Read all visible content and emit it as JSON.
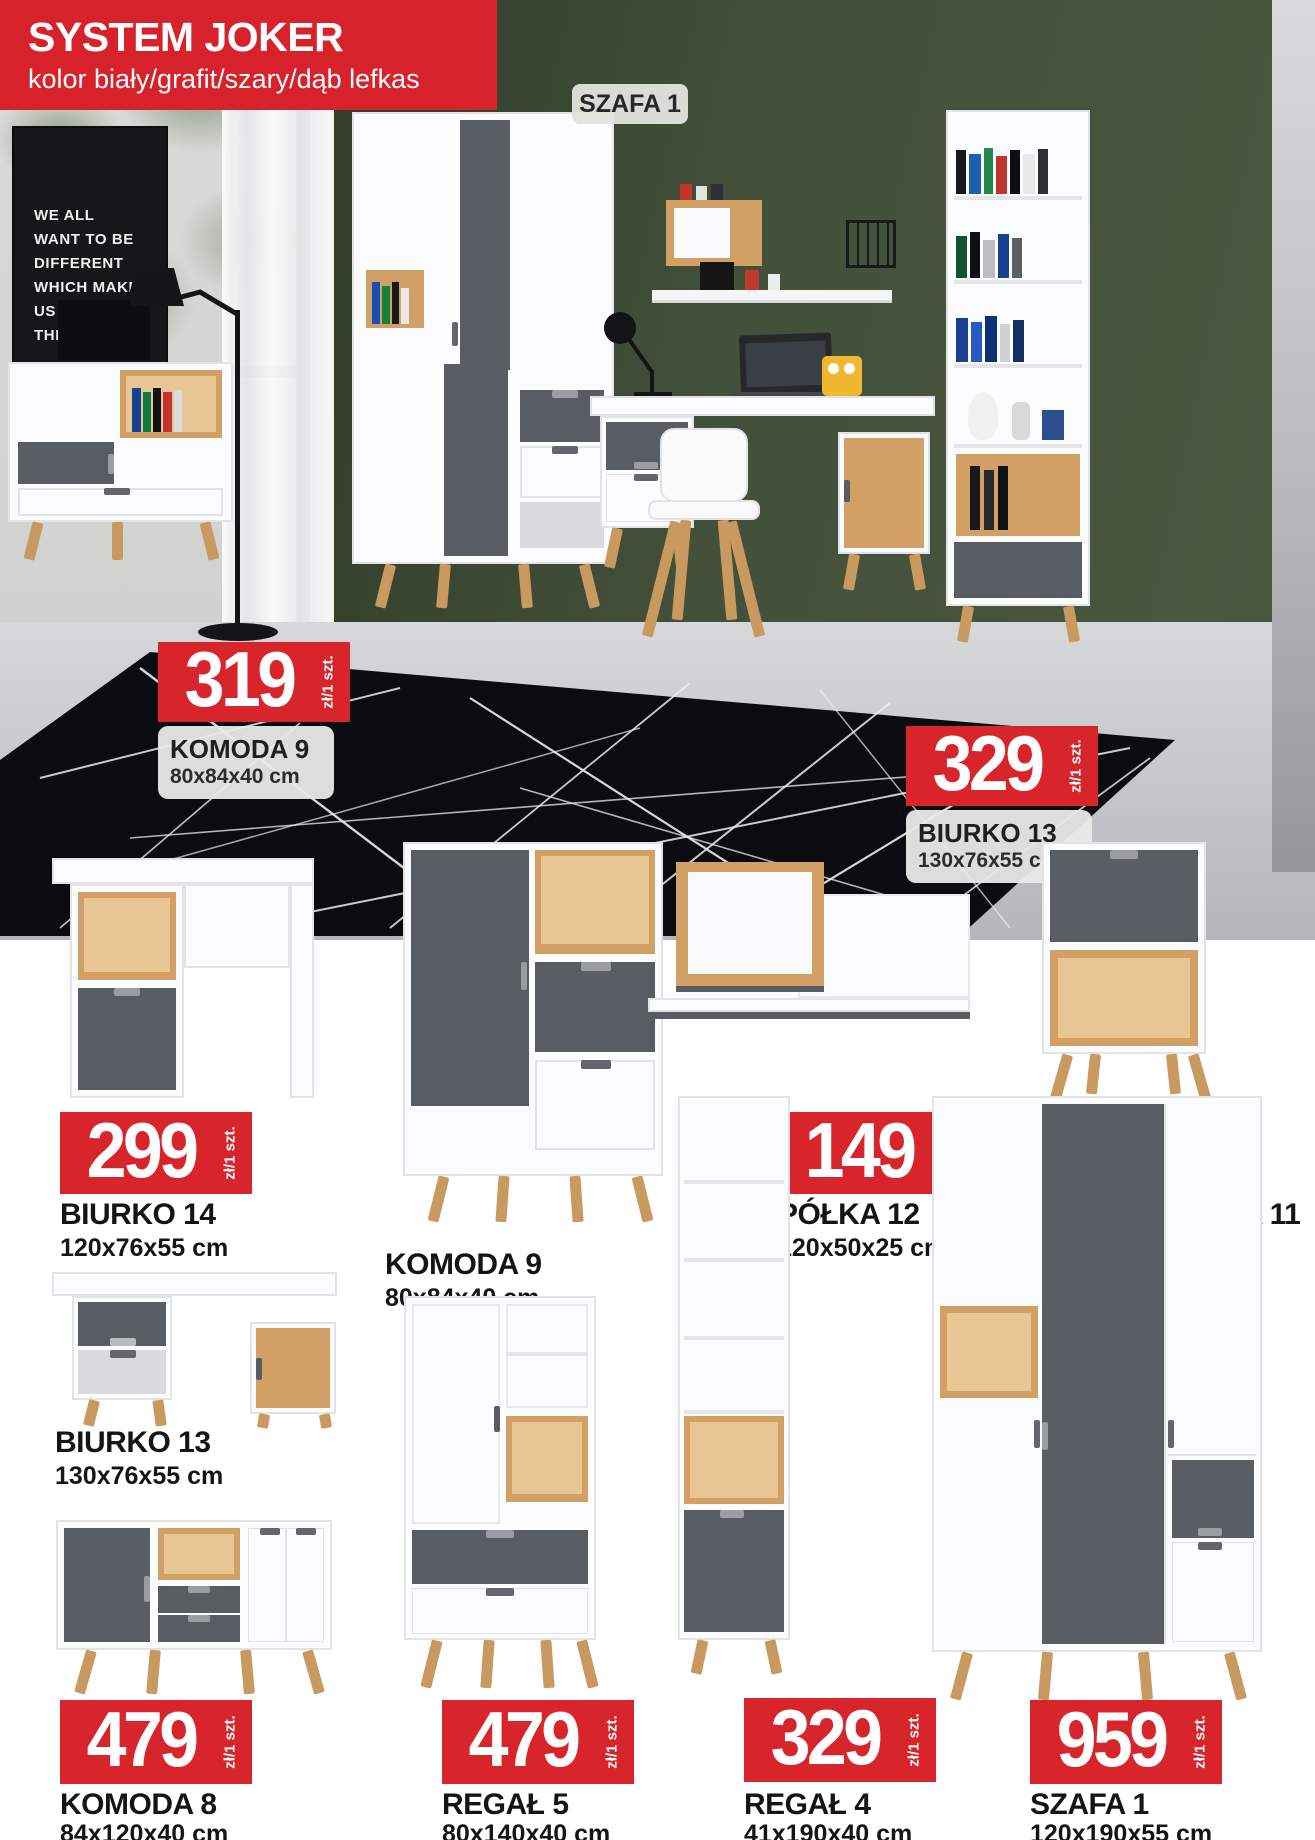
{
  "banner": {
    "title": "SYSTEM JOKER",
    "subtitle": "kolor biały/grafit/szary/dąb lefkas"
  },
  "scene": {
    "wardrobe_tag": "SZAFA 1",
    "poster_lines": [
      "WE ALL",
      "WANT TO BE",
      "DIFFERENT",
      "WHICH MAKES",
      "US ALL",
      "THE SAME"
    ],
    "price_tags": [
      {
        "price": "319",
        "unit": "zł/1 szt.",
        "name": "KOMODA 9",
        "dims": "80x84x40 cm"
      },
      {
        "price": "329",
        "unit": "zł/1 szt.",
        "name": "BIURKO 13",
        "dims": "130x76x55 cm"
      }
    ]
  },
  "products": [
    {
      "name": "BIURKO 14",
      "dims": "120x76x55 cm",
      "price": "299",
      "unit": "zł/1 szt."
    },
    {
      "name": "KOMODA 9",
      "dims": "80x84x40 cm"
    },
    {
      "name": "PÓŁKA 12",
      "dims": "120x50x25 cm",
      "price": "149",
      "unit": "zł/1 szt."
    },
    {
      "name": "SZAFKA NOCNA 11",
      "dims": "41x58x40 cm",
      "price": "199",
      "unit": "zł/1 szt."
    },
    {
      "name": "BIURKO 13",
      "dims": "130x76x55 cm"
    },
    {
      "name": "KOMODA 8",
      "dims": "84x120x40 cm",
      "price": "479",
      "unit": "zł/1 szt."
    },
    {
      "name": "REGAŁ 5",
      "dims": "80x140x40 cm",
      "price": "479",
      "unit": "zł/1 szt."
    },
    {
      "name": "REGAŁ 4",
      "dims": "41x190x40 cm",
      "price": "329",
      "unit": "zł/1 szt."
    },
    {
      "name": "SZAFA 1",
      "dims": "120x190x55 cm",
      "price": "959",
      "unit": "zł/1 szt."
    }
  ],
  "colors": {
    "accent_red": "#d8242b",
    "wall_green": "#43503a",
    "grafit": "#585c63",
    "wood_oak": "#d2a064",
    "label_bg": "#e9eae7"
  }
}
